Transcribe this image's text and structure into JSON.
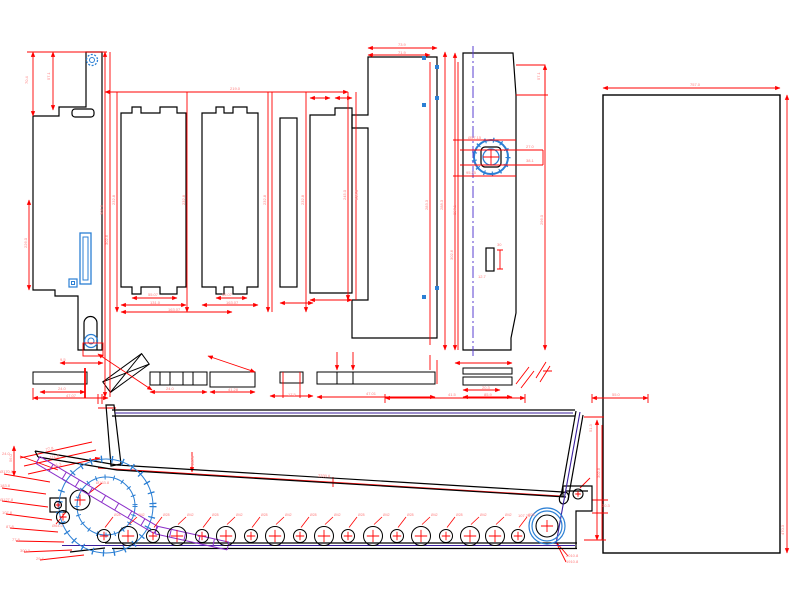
{
  "canvas": {
    "width": 800,
    "height": 600,
    "background": "#ffffff",
    "description": "CAD drawing: sheet-metal flat patterns of conveyor panels (top) and chip-conveyor side elevation with roller chain (bottom)"
  },
  "colors": {
    "outline": "#000000",
    "dimension": "#ff0000",
    "dimension_text": "#ff8080",
    "detail_blue": "#2b7fd4",
    "centerline": "#5a3fd0",
    "rail_purple": "#3b1f9e",
    "ladder_purple": "#8b2fc9"
  },
  "views": [
    {
      "name": "flat-pattern-panels"
    },
    {
      "name": "conveyor-side-elevation"
    }
  ],
  "blue_squares": [
    {
      "x": 424,
      "y": 58
    },
    {
      "x": 437,
      "y": 67
    },
    {
      "x": 437,
      "y": 98
    },
    {
      "x": 424,
      "y": 105
    },
    {
      "x": 437,
      "y": 288
    },
    {
      "x": 424,
      "y": 297
    }
  ],
  "rollers": {
    "cy": 536,
    "items": [
      {
        "x": 104,
        "r": 6.5,
        "label": "Ø28"
      },
      {
        "x": 128,
        "r": 9.5,
        "label": "Ø42"
      },
      {
        "x": 153,
        "r": 6.5,
        "label": "Ø28"
      },
      {
        "x": 177,
        "r": 9.5,
        "label": "Ø42"
      },
      {
        "x": 202,
        "r": 6.5,
        "label": "Ø28"
      },
      {
        "x": 226,
        "r": 9.5,
        "label": "Ø42"
      },
      {
        "x": 251,
        "r": 6.5,
        "label": "Ø28"
      },
      {
        "x": 275,
        "r": 9.5,
        "label": "Ø42"
      },
      {
        "x": 300,
        "r": 6.5,
        "label": "Ø28"
      },
      {
        "x": 324,
        "r": 9.5,
        "label": "Ø42"
      },
      {
        "x": 348,
        "r": 6.5,
        "label": "Ø28"
      },
      {
        "x": 373,
        "r": 9.5,
        "label": "Ø42"
      },
      {
        "x": 397,
        "r": 6.5,
        "label": "Ø28"
      },
      {
        "x": 421,
        "r": 9.5,
        "label": "Ø42"
      },
      {
        "x": 446,
        "r": 6.5,
        "label": "Ø28"
      },
      {
        "x": 470,
        "r": 9.5,
        "label": "Ø42"
      },
      {
        "x": 495,
        "r": 9.5,
        "label": "Ø42"
      },
      {
        "x": 518,
        "r": 6.5,
        "label": "Ø28"
      }
    ]
  },
  "head_wheels": [
    {
      "x": 80,
      "y": 500,
      "r": 10
    },
    {
      "x": 63,
      "y": 517,
      "r": 6.5
    },
    {
      "x": 58,
      "y": 505,
      "r": 3.5
    },
    {
      "x": 578,
      "y": 494,
      "r": 5
    },
    {
      "x": 547,
      "y": 526,
      "r": 11
    }
  ],
  "ladders": [
    {
      "x1": 38,
      "y1": 460,
      "x2": 156,
      "y2": 530,
      "gap": 8,
      "rungs": 9
    },
    {
      "x1": 156,
      "y1": 530,
      "x2": 228,
      "y2": 546,
      "gap": 8,
      "rungs": 5
    }
  ],
  "dimension_labels": [
    {
      "x": 28,
      "y": 84,
      "t": "70.4",
      "r": -90
    },
    {
      "x": 50,
      "y": 80,
      "t": "57.1",
      "r": -90
    },
    {
      "x": 103,
      "y": 215,
      "t": "302.6",
      "r": -90
    },
    {
      "x": 108,
      "y": 245,
      "t": "302.6",
      "r": -90
    },
    {
      "x": 27,
      "y": 248,
      "t": "226.0",
      "r": -90
    },
    {
      "x": 115,
      "y": 205,
      "t": "232.8",
      "r": -90
    },
    {
      "x": 185,
      "y": 205,
      "t": "232.8",
      "r": -90
    },
    {
      "x": 266,
      "y": 205,
      "t": "232.8",
      "r": -90
    },
    {
      "x": 304,
      "y": 205,
      "t": "232.8",
      "r": -90
    },
    {
      "x": 346,
      "y": 200,
      "t": "245.0",
      "r": -90
    },
    {
      "x": 358,
      "y": 200,
      "t": "245.0",
      "r": -90
    },
    {
      "x": 230,
      "y": 90,
      "t": "219.0"
    },
    {
      "x": 398,
      "y": 46,
      "t": "73.9"
    },
    {
      "x": 398,
      "y": 54,
      "t": "71.9"
    },
    {
      "x": 428,
      "y": 210,
      "t": "283.3",
      "r": -90
    },
    {
      "x": 443,
      "y": 210,
      "t": "288.3",
      "r": -90
    },
    {
      "x": 456,
      "y": 215,
      "t": "297.1",
      "r": -90
    },
    {
      "x": 453,
      "y": 260,
      "t": "302.6",
      "r": -90
    },
    {
      "x": 543,
      "y": 225,
      "t": "296.0",
      "r": -90
    },
    {
      "x": 690,
      "y": 86,
      "t": "757.0"
    },
    {
      "x": 784,
      "y": 535,
      "t": "470.3",
      "r": -90
    },
    {
      "x": 148,
      "y": 296,
      "t": "55.07"
    },
    {
      "x": 150,
      "y": 304,
      "t": "131.0"
    },
    {
      "x": 168,
      "y": 311,
      "t": "163.07"
    },
    {
      "x": 222,
      "y": 296,
      "t": "55.07"
    },
    {
      "x": 226,
      "y": 304,
      "t": "163.07"
    },
    {
      "x": 60,
      "y": 361,
      "t": "9.5"
    },
    {
      "x": 58,
      "y": 390,
      "t": "24.0"
    },
    {
      "x": 66,
      "y": 397,
      "t": "47.07"
    },
    {
      "x": 166,
      "y": 390,
      "t": "24.0"
    },
    {
      "x": 228,
      "y": 391,
      "t": "41.28"
    },
    {
      "x": 288,
      "y": 396,
      "t": "17.5"
    },
    {
      "x": 366,
      "y": 395,
      "t": "47.01"
    },
    {
      "x": 482,
      "y": 389,
      "t": "20.3"
    },
    {
      "x": 484,
      "y": 396,
      "t": "85.9"
    },
    {
      "x": 468,
      "y": 139,
      "t": "Ø57.15"
    },
    {
      "x": 526,
      "y": 148,
      "t": "27.0"
    },
    {
      "x": 526,
      "y": 162,
      "t": "38.1"
    },
    {
      "x": 466,
      "y": 174,
      "t": "95.25"
    },
    {
      "x": 540,
      "y": 80,
      "t": "57.1",
      "r": -90
    },
    {
      "x": 497,
      "y": 246,
      "t": "30"
    },
    {
      "x": 478,
      "y": 278,
      "t": "12.7"
    },
    {
      "x": 448,
      "y": 396,
      "t": "41.5"
    },
    {
      "x": 612,
      "y": 396,
      "t": "55.0"
    },
    {
      "x": 46,
      "y": 451,
      "t": "77.8",
      "r": -12
    },
    {
      "x": 50,
      "y": 459,
      "t": "111.8",
      "r": -12
    },
    {
      "x": 54,
      "y": 467,
      "t": "41.3",
      "r": -12
    },
    {
      "x": 12,
      "y": 462,
      "t": "56.0",
      "r": -90
    },
    {
      "x": 194,
      "y": 466,
      "t": "108.0",
      "r": -90
    },
    {
      "x": 96,
      "y": 484,
      "t": "Ø163.8"
    },
    {
      "x": 52,
      "y": 527,
      "t": "Ø64.0"
    },
    {
      "x": 2,
      "y": 455,
      "t": "24.0"
    },
    {
      "x": 0,
      "y": 473,
      "t": "Ø170.0"
    },
    {
      "x": 0,
      "y": 487,
      "t": "183.8"
    },
    {
      "x": 0,
      "y": 501,
      "t": "Ø127.8"
    },
    {
      "x": 2,
      "y": 514,
      "t": "107.8"
    },
    {
      "x": 6,
      "y": 528,
      "t": "87.8"
    },
    {
      "x": 12,
      "y": 541,
      "t": "77.8"
    },
    {
      "x": 20,
      "y": 552,
      "t": "300.0"
    },
    {
      "x": 36,
      "y": 560,
      "t": "29.4"
    },
    {
      "x": 566,
      "y": 557,
      "t": "2010.8"
    },
    {
      "x": 566,
      "y": 563,
      "t": "1910.8"
    },
    {
      "x": 518,
      "y": 517,
      "t": "107.25"
    },
    {
      "x": 600,
      "y": 478,
      "t": "302.8",
      "r": -90
    },
    {
      "x": 592,
      "y": 432,
      "t": "51.3",
      "r": -90
    },
    {
      "x": 602,
      "y": 507,
      "t": "30.3"
    },
    {
      "x": 318,
      "y": 477,
      "t": "2330.8",
      "r": 3
    }
  ]
}
